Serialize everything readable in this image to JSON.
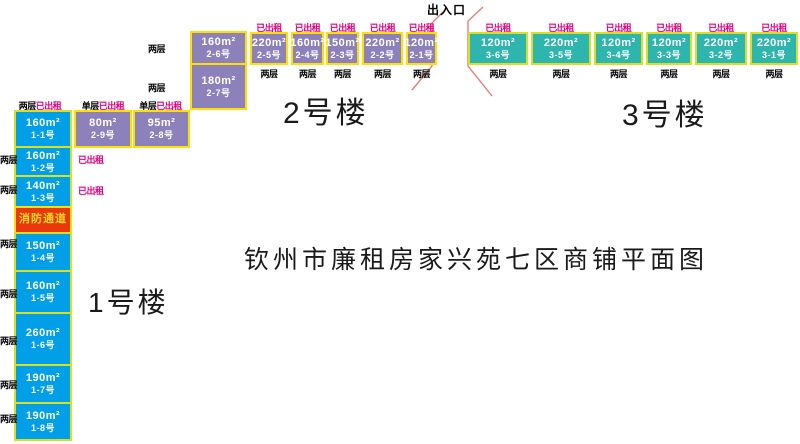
{
  "title": "钦州市廉租房家兴苑七区商铺平面图",
  "entrance_label": "出入口",
  "fire_lane_label": "消防通道",
  "tags": {
    "two_storey": "两层",
    "single_storey": "单层",
    "rented": "已出租"
  },
  "colors": {
    "building1_blue": "#009FE8",
    "building2_purple": "#8D81BC",
    "building3_teal": "#2EB6AE",
    "border_yellow_green": "#D9E021",
    "border_yellow": "#FFE100",
    "rented_magenta": "#E5007E",
    "fire_lane_red": "#E8380D",
    "fire_lane_text": "#FFD720",
    "entrance_line_pink": "#EE7B74"
  },
  "building1": {
    "label": "1号楼",
    "units": [
      {
        "area": "160m²",
        "no": "1-1号"
      },
      {
        "area": "160m²",
        "no": "1-2号"
      },
      {
        "area": "140m²",
        "no": "1-3号"
      },
      {
        "area": "150m²",
        "no": "1-4号"
      },
      {
        "area": "160m²",
        "no": "1-5号"
      },
      {
        "area": "260m²",
        "no": "1-6号"
      },
      {
        "area": "190m²",
        "no": "1-7号"
      },
      {
        "area": "190m²",
        "no": "1-8号"
      }
    ]
  },
  "building2": {
    "label": "2号楼",
    "units": [
      {
        "area": "80m²",
        "no": "2-9号"
      },
      {
        "area": "95m²",
        "no": "2-8号"
      },
      {
        "area": "180m²",
        "no": "2-7号"
      },
      {
        "area": "160m²",
        "no": "2-6号"
      },
      {
        "area": "220m²",
        "no": "2-5号"
      },
      {
        "area": "160m²",
        "no": "2-4号"
      },
      {
        "area": "150m²",
        "no": "2-3号"
      },
      {
        "area": "220m²",
        "no": "2-2号"
      },
      {
        "area": "120m²",
        "no": "2-1号"
      }
    ]
  },
  "building3": {
    "label": "3号楼",
    "units": [
      {
        "area": "120m²",
        "no": "3-6号"
      },
      {
        "area": "220m²",
        "no": "3-5号"
      },
      {
        "area": "120m²",
        "no": "3-4号"
      },
      {
        "area": "120m²",
        "no": "3-3号"
      },
      {
        "area": "220m²",
        "no": "3-2号"
      },
      {
        "area": "220m²",
        "no": "3-1号"
      }
    ]
  }
}
